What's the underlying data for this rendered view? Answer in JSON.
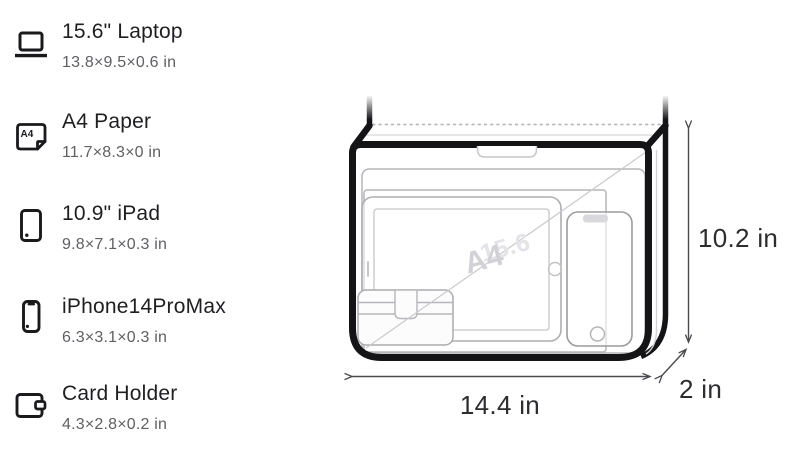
{
  "legend": {
    "a4_icon_label": "A4",
    "items": [
      {
        "icon": "laptop-icon",
        "name": "15.6\" Laptop",
        "dims": "13.8×9.5×0.6 in"
      },
      {
        "icon": "a4-paper-icon",
        "name": "A4 Paper",
        "dims": "11.7×8.3×0 in"
      },
      {
        "icon": "ipad-icon",
        "name": "10.9\" iPad",
        "dims": "9.8×7.1×0.3 in"
      },
      {
        "icon": "iphone-icon",
        "name": "iPhone14ProMax",
        "dims": "6.3×3.1×0.3 in"
      },
      {
        "icon": "card-holder-icon",
        "name": "Card Holder",
        "dims": "4.3×2.8×0.2 in"
      }
    ]
  },
  "diagram": {
    "height_label": "10.2 in",
    "width_label": "14.4 in",
    "depth_label": "2 in",
    "watermarks": {
      "a4": "A4",
      "laptop": "15.6"
    }
  },
  "colors": {
    "bag_outline": "#141417",
    "item_outline": "#b6b6ba",
    "title_text": "#1f1f22",
    "subtitle_text": "#5f5f64",
    "dimension_text": "#2d2d30",
    "watermark_a4": "#d2d2d6",
    "watermark_laptop": "#e4e4e8"
  }
}
